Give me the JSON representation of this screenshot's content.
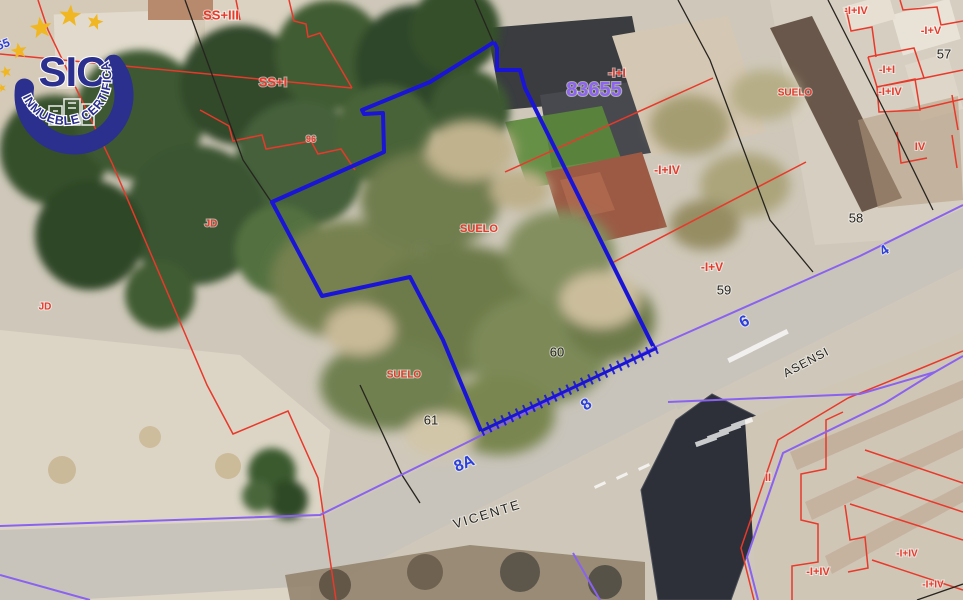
{
  "logo": {
    "brand": "SIC",
    "tagline": "INMUEBLE CERTIFICADO",
    "star_count": 6,
    "colors": {
      "navy": "#2b2f8e",
      "gold": "#f0b722"
    }
  },
  "map": {
    "reference_number": "83655",
    "street_names": [
      "VICENTE",
      "ASENSI"
    ],
    "street_numbers": [
      "4",
      "6",
      "8",
      "8A",
      "55"
    ],
    "parcel_numbers": [
      "57",
      "58",
      "59",
      "60",
      "61"
    ],
    "colors": {
      "red": "#e8392b",
      "black": "#26241f",
      "blue": "#2b3fe0",
      "violet": "#8f63f2"
    },
    "labels": [
      {
        "text": "SS+III",
        "x": 221,
        "y": 15,
        "color": "red",
        "size": 13,
        "bold": true,
        "rot": 0,
        "kind": "floors"
      },
      {
        "text": "SS+I",
        "x": 273,
        "y": 82,
        "color": "red",
        "size": 13,
        "bold": true,
        "rot": 0,
        "kind": "floors"
      },
      {
        "text": "96",
        "x": 311,
        "y": 139,
        "color": "red",
        "size": 9,
        "bold": true,
        "rot": 0,
        "kind": "zone"
      },
      {
        "text": "JD",
        "x": 211,
        "y": 223,
        "color": "red",
        "size": 10,
        "bold": true,
        "rot": 0,
        "kind": "zone"
      },
      {
        "text": "JD",
        "x": 45,
        "y": 306,
        "color": "red",
        "size": 10,
        "bold": true,
        "rot": 0,
        "kind": "zone"
      },
      {
        "text": "SUELO",
        "x": 479,
        "y": 228,
        "color": "red",
        "size": 11,
        "bold": true,
        "rot": 0,
        "kind": "zone"
      },
      {
        "text": "SUELO",
        "x": 404,
        "y": 374,
        "color": "red",
        "size": 10,
        "bold": true,
        "rot": 0,
        "kind": "zone"
      },
      {
        "text": "SUELO",
        "x": 795,
        "y": 92,
        "color": "red",
        "size": 10,
        "bold": true,
        "rot": 0,
        "kind": "zone"
      },
      {
        "text": "-I+I",
        "x": 617,
        "y": 73,
        "color": "red",
        "size": 12,
        "bold": true,
        "rot": 0,
        "kind": "floors"
      },
      {
        "text": "83655",
        "x": 594,
        "y": 89,
        "color": "violet",
        "size": 20,
        "bold": true,
        "rot": 0,
        "kind": "parcel-reference"
      },
      {
        "text": "-I+IV",
        "x": 667,
        "y": 170,
        "color": "red",
        "size": 12,
        "bold": true,
        "rot": 0,
        "kind": "floors"
      },
      {
        "text": "-I+V",
        "x": 712,
        "y": 267,
        "color": "red",
        "size": 12,
        "bold": true,
        "rot": 0,
        "kind": "floors"
      },
      {
        "text": "59",
        "x": 724,
        "y": 290,
        "color": "black",
        "size": 13,
        "bold": false,
        "rot": 0,
        "kind": "parcel-number"
      },
      {
        "text": "60",
        "x": 557,
        "y": 352,
        "color": "black",
        "size": 13,
        "bold": false,
        "rot": 0,
        "kind": "parcel-number"
      },
      {
        "text": "61",
        "x": 431,
        "y": 420,
        "color": "black",
        "size": 13,
        "bold": false,
        "rot": 0,
        "kind": "parcel-number"
      },
      {
        "text": "58",
        "x": 856,
        "y": 218,
        "color": "black",
        "size": 13,
        "bold": false,
        "rot": 0,
        "kind": "parcel-number"
      },
      {
        "text": "57",
        "x": 944,
        "y": 54,
        "color": "black",
        "size": 13,
        "bold": false,
        "rot": 0,
        "kind": "parcel-number"
      },
      {
        "text": "8",
        "x": 586,
        "y": 404,
        "color": "blue",
        "size": 16,
        "bold": true,
        "rot": -38,
        "kind": "street-number"
      },
      {
        "text": "8A",
        "x": 464,
        "y": 463,
        "color": "blue",
        "size": 16,
        "bold": true,
        "rot": -22,
        "kind": "street-number"
      },
      {
        "text": "6",
        "x": 744,
        "y": 321,
        "color": "blue",
        "size": 16,
        "bold": true,
        "rot": -28,
        "kind": "street-number"
      },
      {
        "text": "4",
        "x": 884,
        "y": 250,
        "color": "blue",
        "size": 14,
        "bold": true,
        "rot": -35,
        "kind": "street-number"
      },
      {
        "text": "55",
        "x": 3,
        "y": 44,
        "color": "blue",
        "size": 12,
        "bold": true,
        "rot": -20,
        "kind": "street-number"
      },
      {
        "text": "VICENTE",
        "x": 487,
        "y": 514,
        "color": "black",
        "size": 13,
        "bold": false,
        "rot": -17,
        "spacing": 2,
        "kind": "street-name"
      },
      {
        "text": "ASENSI",
        "x": 806,
        "y": 362,
        "color": "black",
        "size": 12,
        "bold": false,
        "rot": -28,
        "spacing": 1,
        "kind": "street-name"
      },
      {
        "text": "II",
        "x": 768,
        "y": 477,
        "color": "red",
        "size": 11,
        "bold": true,
        "rot": 0,
        "kind": "floors"
      },
      {
        "text": "-I+IV",
        "x": 818,
        "y": 571,
        "color": "red",
        "size": 11,
        "bold": true,
        "rot": 0,
        "kind": "floors"
      },
      {
        "text": "-I+IV",
        "x": 856,
        "y": 10,
        "color": "red",
        "size": 11,
        "bold": true,
        "rot": 0,
        "kind": "floors"
      },
      {
        "text": "-I+V",
        "x": 931,
        "y": 30,
        "color": "red",
        "size": 11,
        "bold": true,
        "rot": 0,
        "kind": "floors"
      },
      {
        "text": "-I+I",
        "x": 887,
        "y": 69,
        "color": "red",
        "size": 11,
        "bold": true,
        "rot": 0,
        "kind": "floors"
      },
      {
        "text": "-I+IV",
        "x": 890,
        "y": 91,
        "color": "red",
        "size": 11,
        "bold": true,
        "rot": 0,
        "kind": "floors"
      },
      {
        "text": "IV",
        "x": 920,
        "y": 146,
        "color": "red",
        "size": 11,
        "bold": true,
        "rot": 0,
        "kind": "floors"
      },
      {
        "text": "-I+IV",
        "x": 907,
        "y": 553,
        "color": "red",
        "size": 10,
        "bold": true,
        "rot": 0,
        "kind": "floors"
      },
      {
        "text": "-I+IV",
        "x": 933,
        "y": 584,
        "color": "red",
        "size": 10,
        "bold": true,
        "rot": 0,
        "kind": "floors"
      }
    ]
  }
}
